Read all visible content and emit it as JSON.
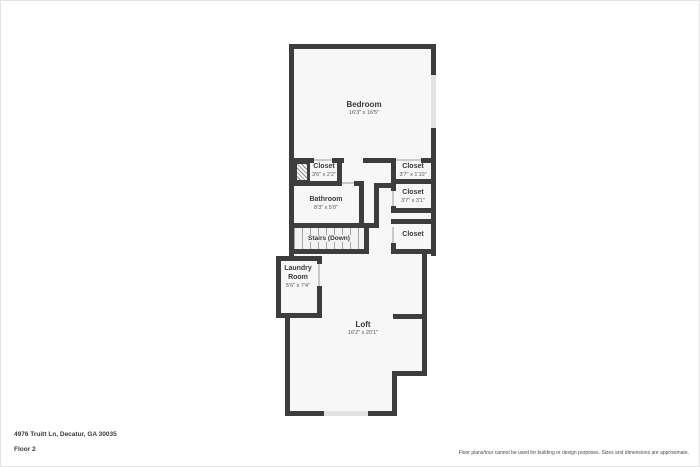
{
  "palette": {
    "wall": "#3d3d3d",
    "room_fill": "#f7f7f7",
    "window_fill": "#e2e2e2",
    "door_line": "#c9c9c9",
    "text": "#3a3a3a"
  },
  "rooms": {
    "bedroom": {
      "name": "Bedroom",
      "dims": "16'3\" x 16'5\""
    },
    "closet_bedroom": {
      "name": "Closet",
      "dims": "3'6\" x 2'2\""
    },
    "closet_right_1": {
      "name": "Closet",
      "dims": "3'7\" x 1'10\""
    },
    "bathroom": {
      "name": "Bathroom",
      "dims": "8'3\" x 5'0\""
    },
    "closet_right_2": {
      "name": "Closet",
      "dims": "3'7\" x 3'1\""
    },
    "stairs": {
      "name": "Stairs (Down)"
    },
    "closet_right_3": {
      "name": "Closet"
    },
    "laundry": {
      "name_line1": "Laundry",
      "name_line2": "Room",
      "dims": "5'6\" x 7'4\""
    },
    "loft": {
      "name": "Loft",
      "dims": "16'2\" x 20'1\""
    }
  },
  "footer": {
    "address": "4976 Truitt Ln, Decatur, GA 30035",
    "floor_label": "Floor 2",
    "disclaimer": "Floor plans/tour cannot be used for building or design purposes. Sizes and dimensions are approximate."
  }
}
